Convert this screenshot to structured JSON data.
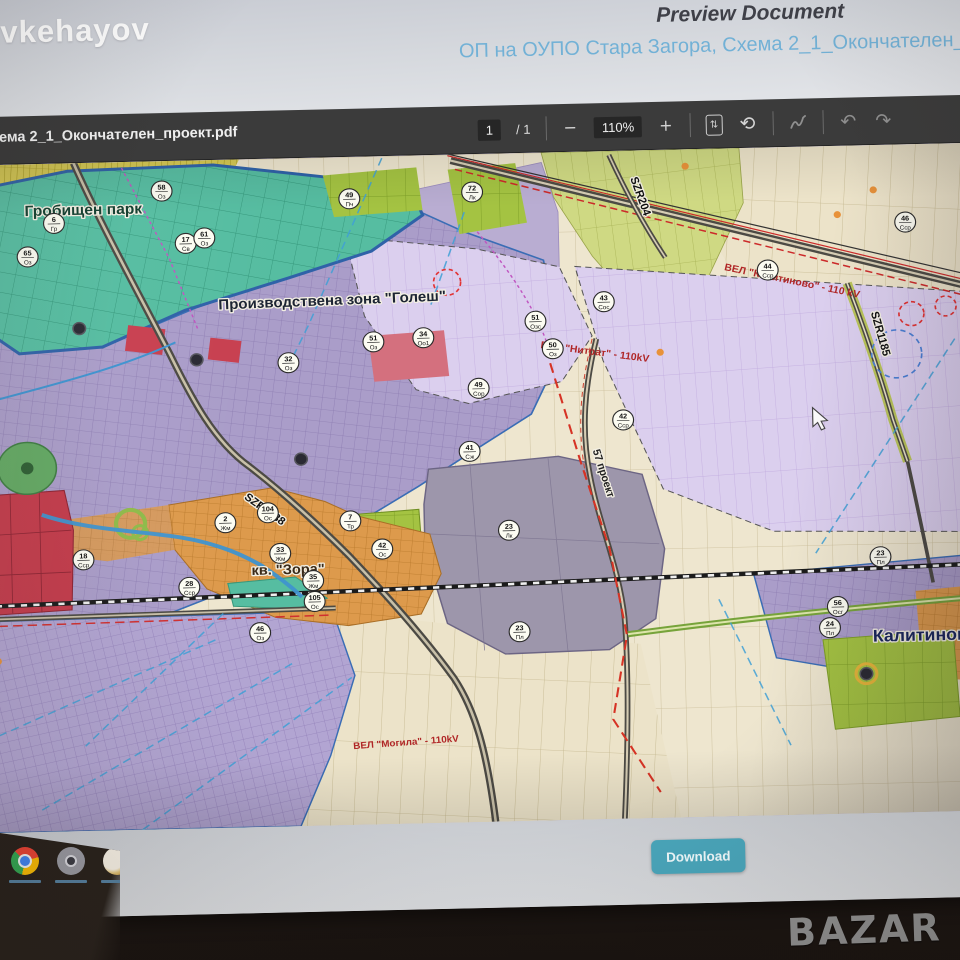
{
  "header": {
    "logo": "vkehayov",
    "title": "Preview Document",
    "subtitle": "ОП на ОУПО Стара Загора, Схема 2_1_Окончателен_про"
  },
  "toolbar": {
    "filename": "Схема 2_1_Окончателен_проект.pdf",
    "page_current": "1",
    "page_divider": "/  1",
    "zoom_out": "−",
    "zoom_level": "110%",
    "zoom_in": "+",
    "fit_icon_glyph": "⇅",
    "rotate_icon_glyph": "⟲",
    "undo_glyph": "↶",
    "redo_glyph": "↷"
  },
  "map": {
    "labels": {
      "park": "Гробищен парк",
      "industrial_zone": "Производствена зона \"Голеш\"",
      "zora": "кв. \"Зора\"",
      "kalitinovo": "Калитиново",
      "road_szr1188": "SZR1188",
      "road_szr204": "SZR204",
      "road_szr1185": "SZR1185",
      "road_57": "57 проект",
      "pwr_kalitinovo": "ВЕЛ \"Калитиново\" - 110 kV",
      "pwr_nitrat": "ВЕЛ \"Нитрат\" - 110kV",
      "pwr_mogila": "ВЕЛ \"Могила\" - 110kV"
    },
    "badges": [
      {
        "n": "6",
        "c": "Гр",
        "x": 76,
        "y": 60
      },
      {
        "n": "65",
        "c": "Оз",
        "x": 50,
        "y": 93
      },
      {
        "n": "58",
        "c": "Оз",
        "x": 180,
        "y": 30
      },
      {
        "n": "17",
        "c": "Св",
        "x": 202,
        "y": 83
      },
      {
        "n": "61",
        "c": "Оз",
        "x": 220,
        "y": 78
      },
      {
        "n": "32",
        "c": "Оз",
        "x": 298,
        "y": 205
      },
      {
        "n": "49",
        "c": "Пч",
        "x": 360,
        "y": 42
      },
      {
        "n": "72",
        "c": "Лк",
        "x": 478,
        "y": 38
      },
      {
        "n": "51",
        "c": "Оз",
        "x": 380,
        "y": 186
      },
      {
        "n": "34",
        "c": "Оо1",
        "x": 428,
        "y": 183
      },
      {
        "n": "43",
        "c": "Сос",
        "x": 602,
        "y": 151
      },
      {
        "n": "51",
        "c": "Озс",
        "x": 536,
        "y": 169
      },
      {
        "n": "50",
        "c": "Оз",
        "x": 552,
        "y": 197
      },
      {
        "n": "49",
        "c": "Сор",
        "x": 480,
        "y": 235
      },
      {
        "n": "42",
        "c": "Сср",
        "x": 618,
        "y": 270
      },
      {
        "n": "46",
        "c": "Сср",
        "x": 893,
        "y": 78
      },
      {
        "n": "44",
        "c": "Сср",
        "x": 760,
        "y": 123
      },
      {
        "n": "41",
        "c": "Сж",
        "x": 470,
        "y": 298
      },
      {
        "n": "23",
        "c": "Лк",
        "x": 506,
        "y": 378
      },
      {
        "n": "104",
        "c": "Ос",
        "x": 275,
        "y": 355
      },
      {
        "n": "2",
        "c": "Жм",
        "x": 234,
        "y": 364
      },
      {
        "n": "33",
        "c": "Жм",
        "x": 286,
        "y": 396
      },
      {
        "n": "7",
        "c": "Тр",
        "x": 354,
        "y": 365
      },
      {
        "n": "42",
        "c": "Ос",
        "x": 384,
        "y": 394
      },
      {
        "n": "35",
        "c": "Жм",
        "x": 317,
        "y": 424
      },
      {
        "n": "105",
        "c": "Ос",
        "x": 318,
        "y": 445
      },
      {
        "n": "28",
        "c": "Сср",
        "x": 198,
        "y": 428
      },
      {
        "n": "18",
        "c": "Сср",
        "x": 97,
        "y": 398
      },
      {
        "n": "46",
        "c": "Оз",
        "x": 265,
        "y": 475
      },
      {
        "n": "23",
        "c": "Пл",
        "x": 514,
        "y": 480
      },
      {
        "n": "23",
        "c": "Пл",
        "x": 862,
        "y": 413
      },
      {
        "n": "56",
        "c": "Осг",
        "x": 820,
        "y": 462
      },
      {
        "n": "24",
        "c": "Пл",
        "x": 812,
        "y": 483
      }
    ],
    "nodes": [
      {
        "x": 210,
        "y": 200
      },
      {
        "x": 308,
        "y": 302
      },
      {
        "x": 98,
        "y": 166
      },
      {
        "x": 846,
        "y": 530,
        "ring": true
      },
      {
        "x": 942,
        "y": 588
      }
    ],
    "dots": [
      {
        "x": 828,
        "y": 69
      },
      {
        "x": 863,
        "y": 45
      },
      {
        "x": 683,
        "y": 17
      },
      {
        "x": 13,
        "y": 498
      },
      {
        "x": 655,
        "y": 203
      }
    ]
  },
  "footer": {
    "download_label": "Download"
  },
  "bottom": {
    "watermark": "BAZAR"
  },
  "taskbar": {
    "icons": [
      "chrome-icon",
      "camera-icon",
      "app-icon"
    ]
  },
  "colors": {
    "subtitle_blue": "#72b1d6",
    "toolbar_bg": "#3b3b3b",
    "download_teal": "#49a5ba",
    "power_line_red": "#b02626",
    "map_lavender": "#aa9dc9",
    "map_pink": "#dbcfee",
    "map_teal_park": "#56bda1",
    "map_orange": "#dd9a4c",
    "map_cream": "#eee6cf"
  }
}
